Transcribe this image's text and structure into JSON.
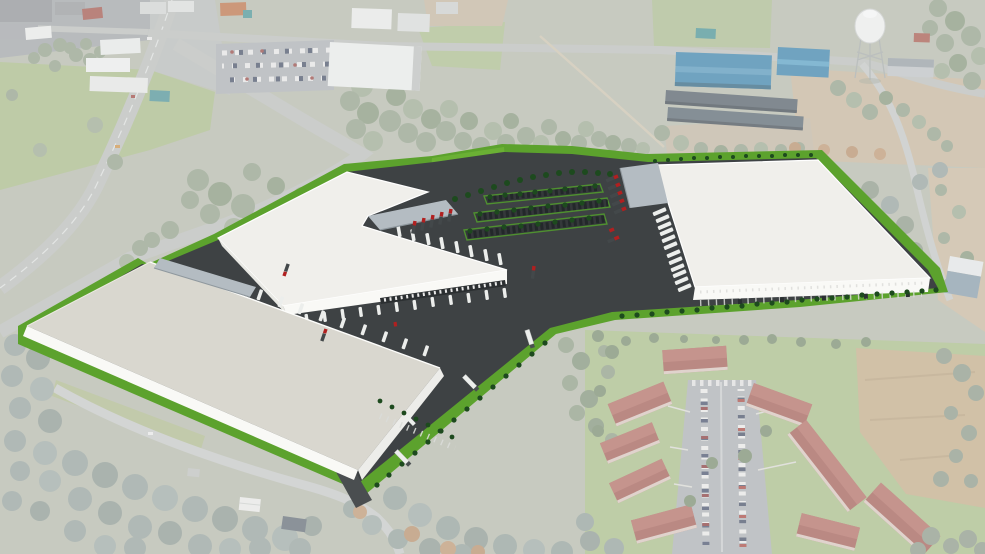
{
  "scene": {
    "title": "Aerial rendering of a proposed three-building industrial park",
    "view": "oblique aerial composite: 3D site plan rendered over an aerial photograph",
    "site": {
      "warehouses": [
        {
          "name": "warehouse-southwest",
          "roof": "light gray",
          "docks_face": "northeast",
          "canopy": "north corner"
        },
        {
          "name": "warehouse-center",
          "shape": "L-shaped",
          "roof": "white",
          "docks_face": "southeast and northeast",
          "canopy": "center notch"
        },
        {
          "name": "warehouse-east",
          "roof": "white",
          "docks_face": "west",
          "canopy": "northwest corner"
        }
      ],
      "ground": [
        "dark asphalt truck courts",
        "bright green landscaping strips",
        "car parking rows with tree islands",
        "shrub hedgerows",
        "terraced lawn berm"
      ],
      "vehicles": {
        "red_tractor_units": "parked at dock canopies",
        "white_trailers": "backed into dock doors",
        "white_semi_trucks": 3
      }
    },
    "surroundings": {
      "northwest": [
        "divided highway interchange",
        "commercial strip buildings",
        "retail parking lot with cars"
      ],
      "north": [
        "tree belt",
        "large white flat-roof building",
        "green field"
      ],
      "northeast": [
        "two blue metal warehouses",
        "two long dark sheds",
        "white water tower on lattice legs",
        "gravel yard"
      ],
      "east": [
        "curving two-lane road",
        "sandy clearing",
        "small blue-gray building"
      ],
      "southwest": [
        "dense wooded canopy",
        "two-lane road",
        "white house",
        "dark-roof house"
      ],
      "southeast": [
        "apartment complex of nine red-roof buildings",
        "central parking aisle full of cars",
        "mowed lawns",
        "brown pasture"
      ]
    },
    "counts": {
      "warehouses": 3,
      "apartment_buildings": 9,
      "blue_buildings": 2,
      "water_towers": 1
    }
  },
  "colors": {
    "asphalt": "#3e4244",
    "asphalt_dark": "#34383a",
    "lawn": "#5ca22d",
    "lawn_light": "#6ab034",
    "shrub": "#1d4a1e",
    "roof_white": "#f0efeb",
    "roof_gray": "#d9d7cf",
    "wall_white": "#f9f9f6",
    "canopy_gray": "#b4bcc2",
    "dock_dark": "#2b2f31",
    "trailer_white": "#eceeec",
    "truck_red": "#b02020",
    "parking_line_green": "#4f9030",
    "road": "#b6bab5",
    "photo_grass": "#a8bb85",
    "photo_field": "#bfa77e",
    "photo_tree": "#8a9a80",
    "photo_tree_cool": "#8d9b95",
    "photo_autumn": "#b2885f",
    "apt_roof": "#9d5248",
    "blue_roof": "#2d7aa4",
    "shed_dark": "#46535b",
    "water_tower": "#edefec",
    "photo_parking": "#a6abad",
    "haze": "#f3f2f7"
  }
}
